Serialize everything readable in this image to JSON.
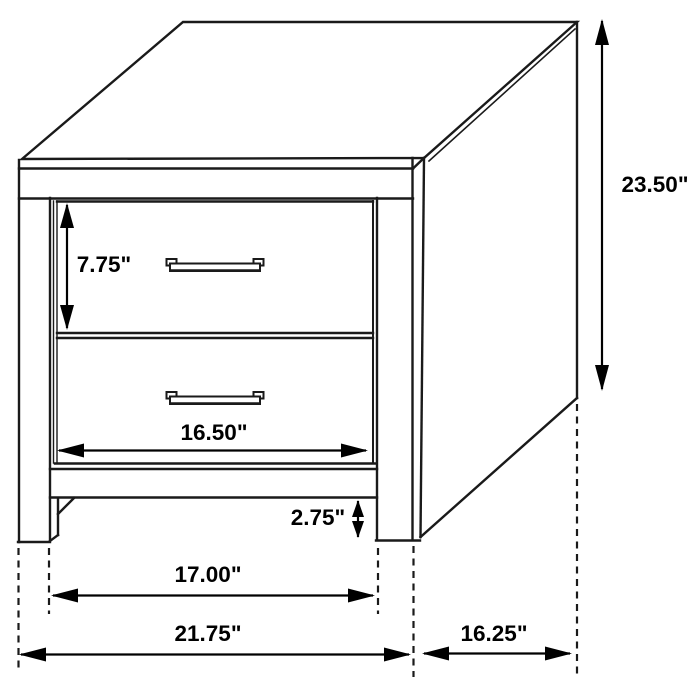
{
  "diagram": {
    "unit": "inches",
    "colors": {
      "background": "#ffffff",
      "line": "#1a1a1a",
      "text": "#000000"
    }
  },
  "dimensions": {
    "drawer_height": "7.75\"",
    "overall_height": "23.50\"",
    "drawer_width": "16.50\"",
    "base_height": "2.75\"",
    "inner_width": "17.00\"",
    "overall_width": "21.75\"",
    "overall_depth": "16.25\""
  }
}
